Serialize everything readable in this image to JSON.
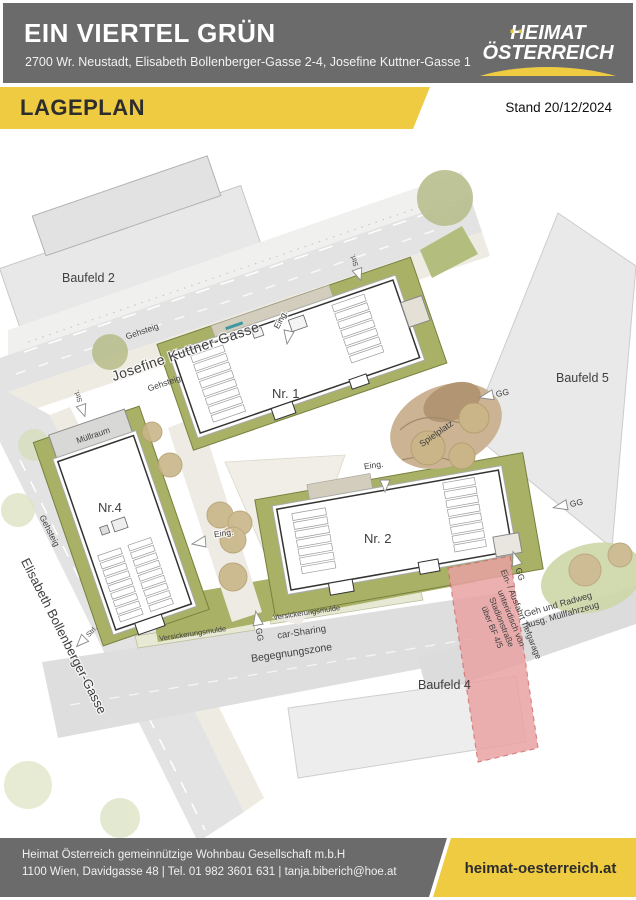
{
  "header": {
    "title": "EIN VIERTEL GRÜN",
    "address": "2700 Wr. Neustadt, Elisabeth Bollenberger-Gasse 2-4, Josefine Kuttner-Gasse 1",
    "logo": {
      "umlaut_dots": "··",
      "line1": "HEIMAT",
      "line2": "ÖSTERREICH"
    }
  },
  "banner": {
    "title": "LAGEPLAN",
    "date": "Stand 20/12/2024"
  },
  "plan": {
    "fields": {
      "baufeld2": "Baufeld 2",
      "baufeld4": "Baufeld 4",
      "baufeld5": "Baufeld 5"
    },
    "streets": {
      "josefine": "Josefine Kuttner-Gasse",
      "elisabeth": "Elisabeth Bollenberger-Gasse",
      "gehsteig": "Gehsteig",
      "begegnungszone": "Begegnungszone",
      "versickerungsmulde": "Versickerungsmulde",
      "car_sharing": "car-Sharing",
      "geh_radweg": [
        "Geh und Radweg",
        "ausg. Müllfahrzeug"
      ]
    },
    "buildings": {
      "nr1": "Nr. 1",
      "nr2": "Nr. 2",
      "nr4": "Nr.4",
      "muellraum": "Müllraum"
    },
    "areas": {
      "spielplatz": "Spielplatz"
    },
    "markers": {
      "eingang": "Eing.",
      "gg": "GG",
      "strasse": "Strl."
    },
    "tiefgarage_note": [
      "Ein- / Ausfahrt Tiefgarage",
      "unterirdisch von",
      "Stadionstraße",
      "über BF 4/5"
    ]
  },
  "footer": {
    "company": "Heimat Österreich gemeinnützige Wohnbau Gesellschaft m.b.H",
    "contact": "1100 Wien, Davidgasse 48 | Tel. 01 982 3601 631 | tanja.biberich@hoe.at",
    "website": "heimat-oesterreich.at"
  },
  "colors": {
    "header_gray": "#6b6b6b",
    "accent_yellow": "#eecb41",
    "site_green": "#a8b166",
    "ramp_pink": "#e9a3a3",
    "field_gray": "#e9e9e9"
  }
}
